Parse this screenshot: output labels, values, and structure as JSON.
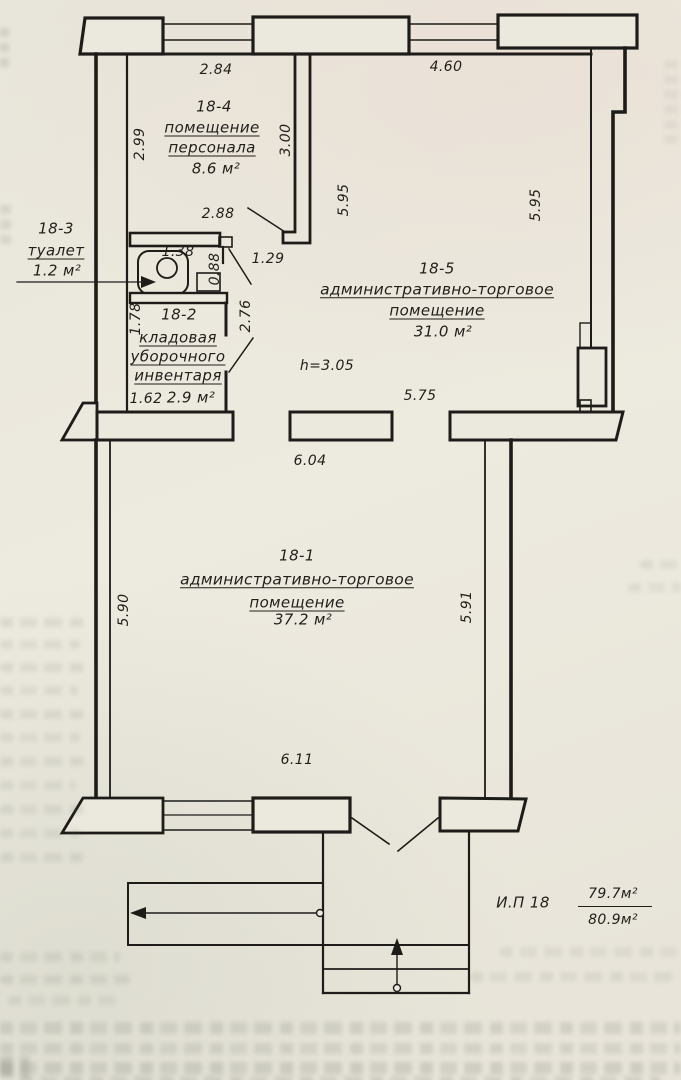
{
  "document": {
    "type_note": "scanned floor plan sheet",
    "line_color": "#1d1c18",
    "paper_color": "#ebe8dd"
  },
  "plan": {
    "rooms": {
      "r18_1": {
        "id": "18-1",
        "name1": "административно-торговое",
        "name2": "помещение",
        "area": "37.2 м²"
      },
      "r18_2": {
        "id": "18-2",
        "name1": "кладовая",
        "name2": "уборочного",
        "name3": "инвентаря",
        "area": "2.9 м²"
      },
      "r18_3": {
        "id": "18-3",
        "name1": "туалет",
        "area": "1.2 м²"
      },
      "r18_4": {
        "id": "18-4",
        "name1": "помещение",
        "name2": "персонала",
        "area": "8.6 м²"
      },
      "r18_5": {
        "id": "18-5",
        "name1": "административно-торговое",
        "name2": "помещение",
        "area": "31.0 м²"
      }
    },
    "dims": {
      "top_left": "2.84",
      "top_right": "4.60",
      "left_18_4": "2.99",
      "right_18_4": "3.00",
      "bottom_18_4": "2.88",
      "toilet_w": "1.38",
      "toilet_h": "0.88",
      "door": "1.29",
      "storage_left": "1.78",
      "storage_right": "2.76",
      "storage_bottom": "1.62",
      "room5_left": "5.95",
      "room5_right": "5.95",
      "room5_bottom": "5.75",
      "opening": "6.04",
      "room1_left": "5.90",
      "room1_right": "5.91",
      "room1_bottom": "6.11",
      "height_note": "h=3.05"
    },
    "summary": {
      "label": "И.П 18",
      "area_top": "79.7м²",
      "area_bottom": "80.9м²"
    }
  }
}
